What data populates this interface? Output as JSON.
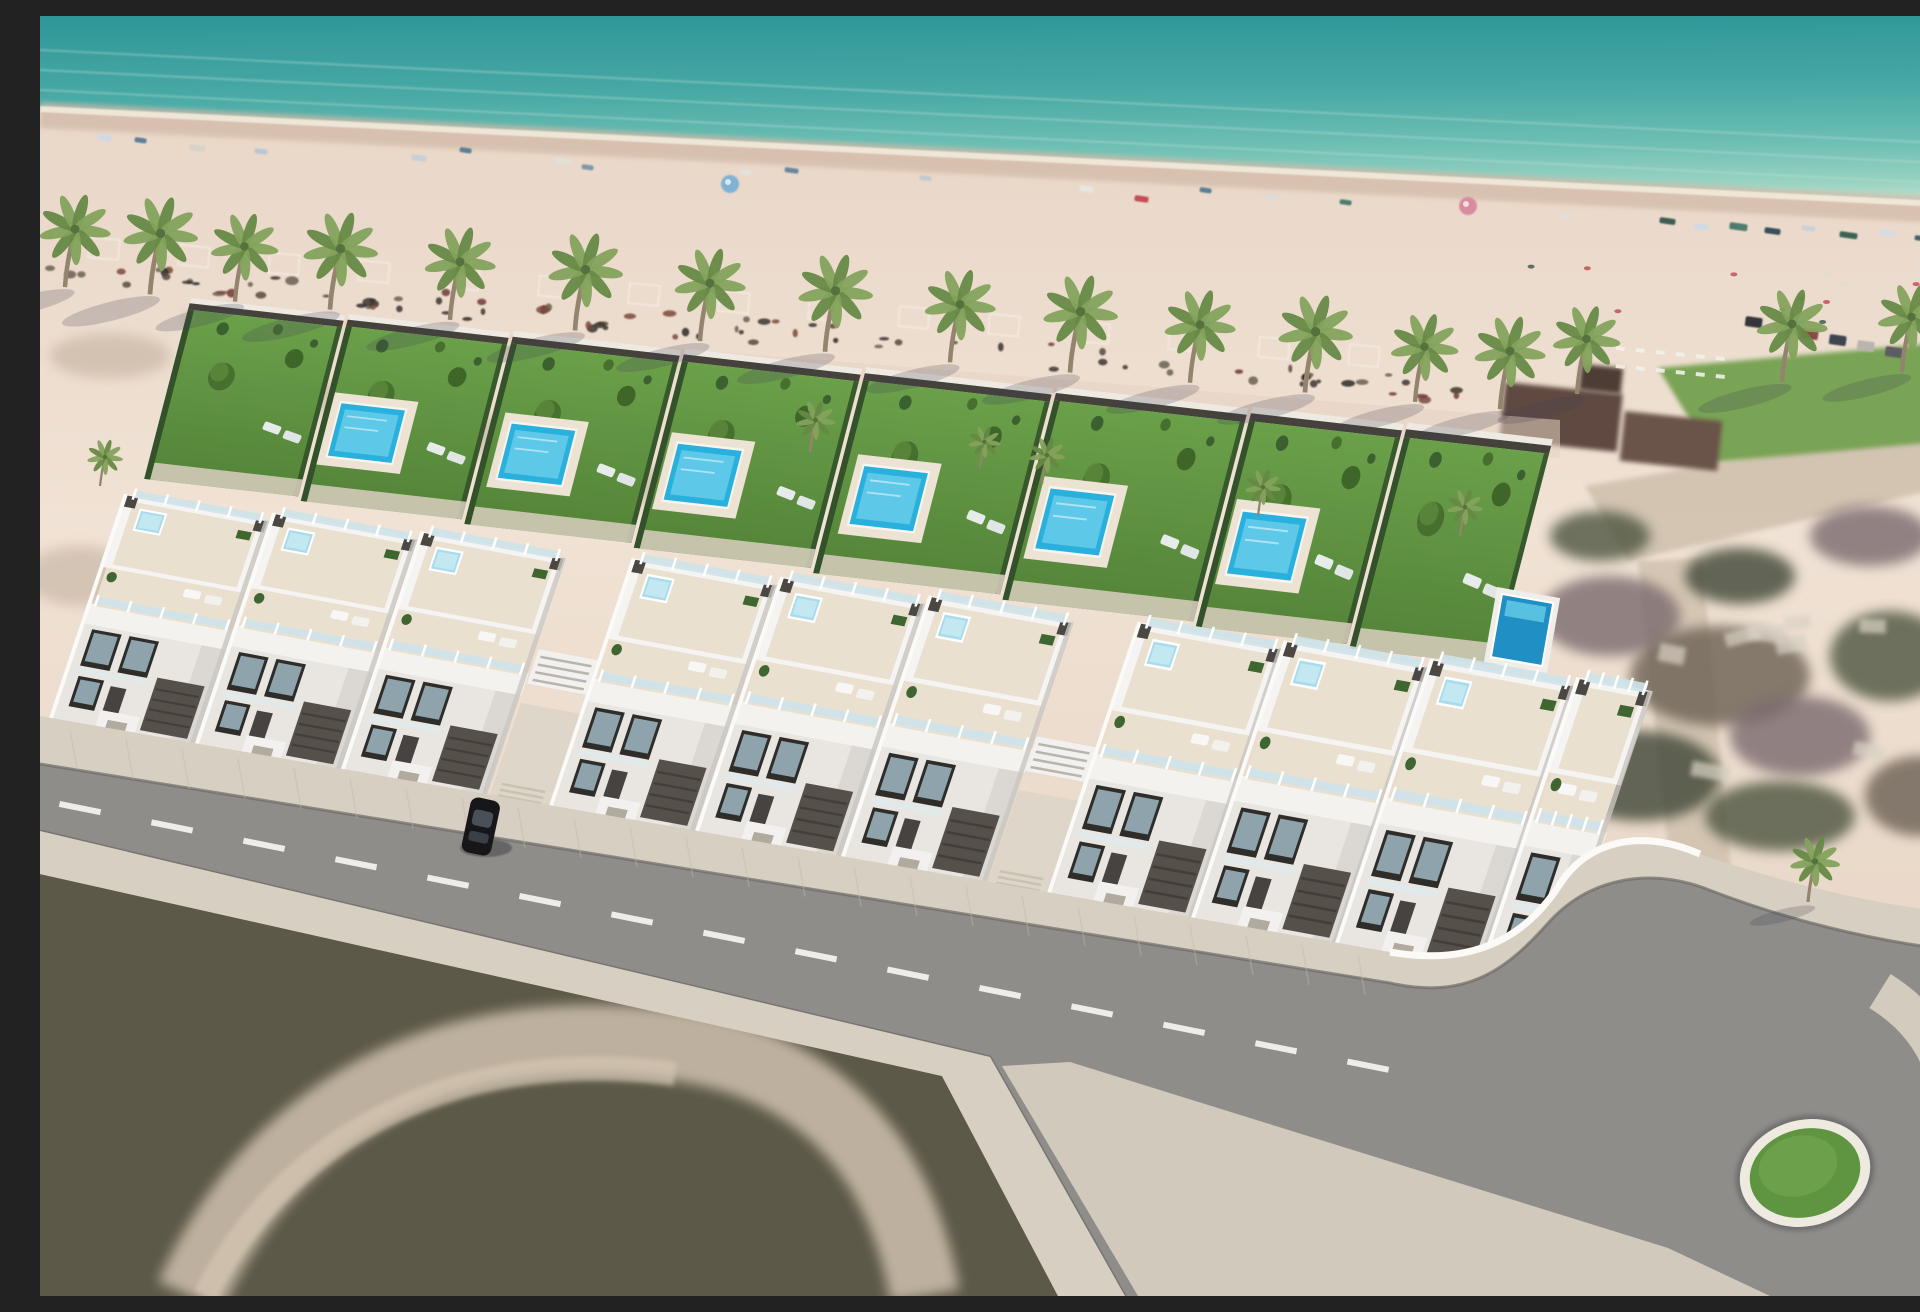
{
  "scene": {
    "kind": "aerial-architectural-render",
    "subject": "beachfront-villa-development",
    "width": 1920,
    "height": 1280
  },
  "palette": {
    "sea_top": "#2e9697",
    "sea_mid": "#48a9a5",
    "sea_low": "#70c0b4",
    "sea_shore": "#9ad3c2",
    "foam": "#f2e9da",
    "wetsand": "#d2b9a7",
    "sand_a": "#e9d7c8",
    "sand_b": "#f0e2d4",
    "sand_c": "#e3cfbe",
    "trunk": "#94836d",
    "palm_green": "#84a25c",
    "palm_dark": "#668944",
    "palm_core": "#55713d",
    "lawn_a": "#6ba04a",
    "lawn_b": "#538338",
    "hedge": "#33512a",
    "shrub": "#47702f",
    "pool": "#29b0dc",
    "pool_light": "#67cdea",
    "pool_deep": "#1f8fc4",
    "jacuzzi": "#a8dcec",
    "white": "#f5f4f2",
    "white_shade": "#dbd8d3",
    "cream": "#e9e0d0",
    "bal_glass": "#cee3ea",
    "fixture": "#4b4742",
    "garage": "#56504a",
    "window_glass": "#8fa3ad",
    "paving": "#ded6c8",
    "road": "#8e8d8a",
    "road_edge": "#6e6b66",
    "sidewalk": "#d7cfc1",
    "curb": "#eeeae0",
    "island": "#5f9440",
    "scrub_a": "#6a6052",
    "scrub_b": "#4e5540",
    "scrub_c": "#7a6a6e",
    "scrub_d": "#3f4637",
    "path": "#cfc0ad",
    "thatch": "#5e4a40",
    "thatch2": "#6b5348",
    "car": "#17171a",
    "dash": "#f4f2ec"
  },
  "sea": {
    "streaks": 3
  },
  "beach": {
    "debris_count": 88,
    "pad_count": 15,
    "towels": [
      {
        "x": 58,
        "y": 118,
        "w": 14,
        "h": 6,
        "c": "#cfd9e4"
      },
      {
        "x": 95,
        "y": 121,
        "w": 12,
        "h": 5,
        "c": "#5b7f97"
      },
      {
        "x": 150,
        "y": 128,
        "w": 16,
        "h": 6,
        "c": "#d8d3c9"
      },
      {
        "x": 215,
        "y": 132,
        "w": 13,
        "h": 5,
        "c": "#b7c6d4"
      },
      {
        "x": 372,
        "y": 138,
        "w": 15,
        "h": 6,
        "c": "#c9cfd6"
      },
      {
        "x": 420,
        "y": 131,
        "w": 12,
        "h": 5,
        "c": "#5b7f97"
      },
      {
        "x": 515,
        "y": 141,
        "w": 18,
        "h": 6,
        "c": "#e3e0d8"
      },
      {
        "x": 542,
        "y": 148,
        "w": 12,
        "h": 5,
        "c": "#7f98ab"
      },
      {
        "x": 700,
        "y": 153,
        "w": 12,
        "h": 5,
        "c": "#dfe2de"
      },
      {
        "x": 745,
        "y": 151,
        "w": 14,
        "h": 5,
        "c": "#6888a0"
      },
      {
        "x": 880,
        "y": 159,
        "w": 12,
        "h": 5,
        "c": "#c4c9cf"
      },
      {
        "x": 1040,
        "y": 169,
        "w": 14,
        "h": 6,
        "c": "#e8e6df"
      },
      {
        "x": 1095,
        "y": 179,
        "w": 14,
        "h": 6,
        "c": "#c24f58"
      },
      {
        "x": 1160,
        "y": 171,
        "w": 12,
        "h": 5,
        "c": "#5b7f97"
      },
      {
        "x": 1225,
        "y": 177,
        "w": 14,
        "h": 5,
        "c": "#dcdcd4"
      },
      {
        "x": 1300,
        "y": 183,
        "w": 12,
        "h": 5,
        "c": "#4e7d6e"
      },
      {
        "x": 1520,
        "y": 197,
        "w": 12,
        "h": 5,
        "c": "#e2dfd7"
      },
      {
        "x": 1620,
        "y": 201,
        "w": 16,
        "h": 6,
        "c": "#3e5d52"
      },
      {
        "x": 1655,
        "y": 207,
        "w": 14,
        "h": 6,
        "c": "#cfd9e4"
      },
      {
        "x": 1690,
        "y": 206,
        "w": 18,
        "h": 7,
        "c": "#4e7d6e"
      },
      {
        "x": 1725,
        "y": 211,
        "w": 16,
        "h": 6,
        "c": "#35505c"
      },
      {
        "x": 1762,
        "y": 209,
        "w": 14,
        "h": 5,
        "c": "#c9d2da"
      },
      {
        "x": 1800,
        "y": 215,
        "w": 18,
        "h": 6,
        "c": "#3e6457"
      },
      {
        "x": 1840,
        "y": 213,
        "w": 16,
        "h": 6,
        "c": "#d5dde3"
      },
      {
        "x": 1875,
        "y": 219,
        "w": 14,
        "h": 5,
        "c": "#46606a"
      },
      {
        "x": 1905,
        "y": 217,
        "w": 12,
        "h": 5,
        "c": "#89a1ad"
      }
    ],
    "umbrellas": [
      {
        "x": 690,
        "y": 168,
        "c": "#7fb3d4"
      },
      {
        "x": 1428,
        "y": 190,
        "c": "#d98ba0"
      }
    ]
  },
  "palms": {
    "row": [
      {
        "x": 25,
        "s": 1.0
      },
      {
        "x": 110,
        "s": 1.05
      },
      {
        "x": 195,
        "s": 0.95
      },
      {
        "x": 290,
        "s": 1.05
      },
      {
        "x": 410,
        "s": 1.0
      },
      {
        "x": 535,
        "s": 1.05
      },
      {
        "x": 660,
        "s": 1.0
      },
      {
        "x": 785,
        "s": 1.05
      },
      {
        "x": 910,
        "s": 1.0
      },
      {
        "x": 1030,
        "s": 1.05
      },
      {
        "x": 1150,
        "s": 1.0
      },
      {
        "x": 1265,
        "s": 1.05
      },
      {
        "x": 1375,
        "s": 0.95
      },
      {
        "x": 1460,
        "s": 1.0
      }
    ],
    "extras": [
      {
        "x": 1537,
        "y": 378,
        "s": 0.95
      },
      {
        "x": 1742,
        "y": 366,
        "s": 1.0
      },
      {
        "x": 1862,
        "y": 356,
        "s": 0.95
      },
      {
        "x": 1768,
        "y": 886,
        "s": 0.7
      },
      {
        "x": 770,
        "y": 436,
        "s": 0.55
      },
      {
        "x": 1002,
        "y": 468,
        "s": 0.5
      },
      {
        "x": 1218,
        "y": 500,
        "s": 0.5
      },
      {
        "x": 1420,
        "y": 520,
        "s": 0.5
      },
      {
        "x": 940,
        "y": 452,
        "s": 0.45
      },
      {
        "x": 60,
        "y": 470,
        "s": 0.5
      }
    ]
  },
  "gardens": {
    "plots": [
      {
        "x": 148,
        "w": 155,
        "pool": false,
        "px": 0
      },
      {
        "x": 306,
        "w": 162,
        "pool": true,
        "px": 14
      },
      {
        "x": 471,
        "w": 168,
        "pool": true,
        "px": 20
      },
      {
        "x": 642,
        "w": 178,
        "pool": true,
        "px": 16
      },
      {
        "x": 823,
        "w": 188,
        "pool": true,
        "px": 22
      },
      {
        "x": 1014,
        "w": 192,
        "pool": true,
        "px": 18
      },
      {
        "x": 1209,
        "w": 152,
        "pool": true,
        "px": 16
      },
      {
        "x": 1364,
        "w": 146,
        "pool": false,
        "px": 0
      }
    ]
  },
  "villas": {
    "unit_w": 144,
    "units": [
      {
        "x": 12
      },
      {
        "x": 158
      },
      {
        "x": 304
      },
      {
        "x": 512
      },
      {
        "x": 658
      },
      {
        "x": 804
      },
      {
        "x": 1010
      },
      {
        "x": 1154
      },
      {
        "x": 1298
      },
      {
        "x": 1442,
        "w": 74,
        "end": true
      }
    ],
    "passages": [
      {
        "x": 450
      },
      {
        "x": 948
      }
    ],
    "elevated_pool": {
      "x": 1462,
      "y": 578,
      "w": 52,
      "h": 64
    }
  },
  "road": {
    "dash_len": 42,
    "dash_step": 92,
    "dash_from": 20,
    "dash_to": 1310
  },
  "roundabout": {
    "cx": 1765,
    "cy": 1157,
    "rx": 62,
    "ry": 50,
    "tilt": -15
  },
  "car": {
    "x": 432,
    "y": 780,
    "w": 30,
    "h": 56,
    "tilt": 12
  },
  "right_area": {
    "cars": 6,
    "sunbeds": 12,
    "crowd": 14
  }
}
